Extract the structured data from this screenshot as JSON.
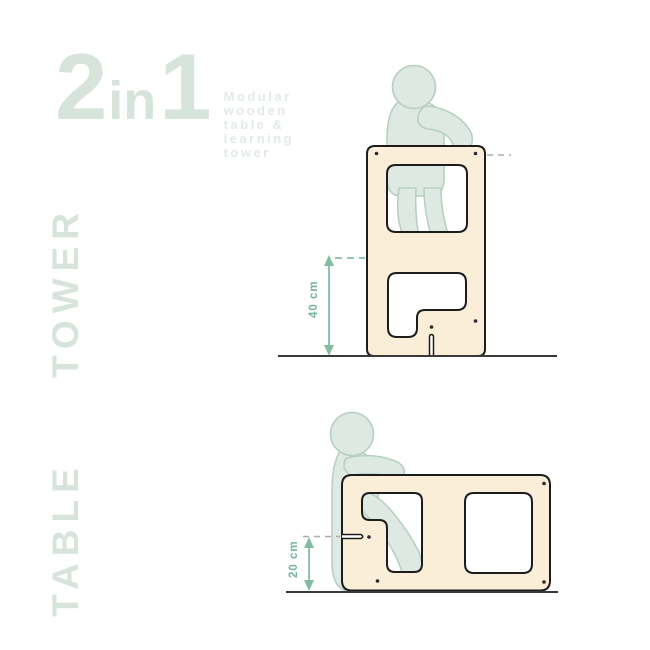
{
  "title": {
    "big_2": "2",
    "big_in": "in",
    "big_1": "1",
    "subtitle_lines": [
      "Modular",
      "wooden",
      "table &",
      "learning",
      "tower"
    ]
  },
  "sections": {
    "tower": {
      "label": "TOWER",
      "dimension_label": "40 cm"
    },
    "table": {
      "label": "TABLE",
      "dimension_label": "20 cm"
    }
  },
  "colors": {
    "accent_green": "#82bda3",
    "dimension_text": "#74b49a",
    "pale_green": "#d7e4dc",
    "pale_green_faint": "#e3ebe6",
    "panel_cream": "#fbeed9",
    "panel_outline": "#1c1c1c",
    "child_fill": "#dde9e2",
    "child_outline": "#b7d0c3",
    "ground": "#3a3a3a",
    "dash_gray": "#a8adab"
  }
}
